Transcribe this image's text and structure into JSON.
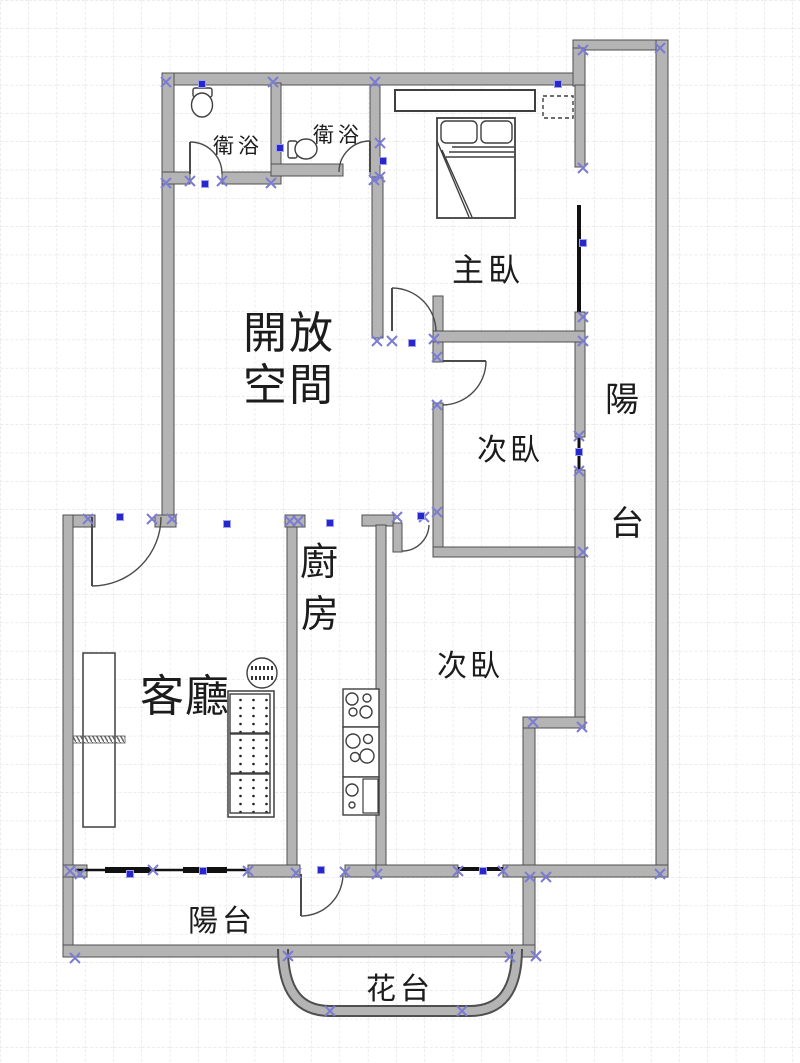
{
  "plan": {
    "width": 800,
    "height": 1063,
    "grid": {
      "spacing": 28.3,
      "color": "#d9d9d9",
      "dash": "3 2"
    },
    "colors": {
      "background": "#ffffff",
      "wall_fill": "#b4b4b4",
      "wall_stroke": "#4f4f4f",
      "line": "#3f3f3f",
      "window": "#111111",
      "marker_cross": "#7b7bd4",
      "marker_square": "#2727cc",
      "text": "#1c1c1c"
    },
    "labels": [
      {
        "name": "open-space-line1",
        "text": "開放",
        "x": 243,
        "y": 348,
        "size": 44,
        "ls": 2
      },
      {
        "name": "open-space-line2",
        "text": "空間",
        "x": 243,
        "y": 400,
        "size": 44,
        "ls": 2
      },
      {
        "name": "master-bedroom",
        "text": "主臥",
        "x": 452,
        "y": 281,
        "size": 32,
        "ls": 4
      },
      {
        "name": "bedroom-upper",
        "text": "次臥",
        "x": 477,
        "y": 460,
        "size": 30,
        "ls": 3
      },
      {
        "name": "bedroom-lower",
        "text": "次臥",
        "x": 437,
        "y": 676,
        "size": 30,
        "ls": 3
      },
      {
        "name": "balcony-right-char1",
        "text": "陽",
        "x": 605,
        "y": 411,
        "size": 34,
        "ls": 0
      },
      {
        "name": "balcony-right-char2",
        "text": "台",
        "x": 610,
        "y": 535,
        "size": 34,
        "ls": 0
      },
      {
        "name": "kitchen-char1",
        "text": "廚",
        "x": 300,
        "y": 575,
        "size": 38,
        "ls": 0
      },
      {
        "name": "kitchen-char2",
        "text": "房",
        "x": 301,
        "y": 627,
        "size": 38,
        "ls": 0
      },
      {
        "name": "living-room",
        "text": "客廳",
        "x": 140,
        "y": 711,
        "size": 44,
        "ls": 1
      },
      {
        "name": "bathroom-1",
        "text": "衛浴",
        "x": 213,
        "y": 153,
        "size": 21,
        "ls": 4
      },
      {
        "name": "bathroom-2",
        "text": "衛浴",
        "x": 313,
        "y": 142,
        "size": 21,
        "ls": 4
      },
      {
        "name": "balcony-bottom",
        "text": "陽台",
        "x": 188,
        "y": 931,
        "size": 30,
        "ls": 4
      },
      {
        "name": "flower-bed",
        "text": "花台",
        "x": 366,
        "y": 999,
        "size": 30,
        "ls": 4
      }
    ],
    "walls": [
      {
        "n": "wall-top-outer",
        "x": 162,
        "y": 73,
        "w": 423,
        "h": 12
      },
      {
        "n": "wall-balcony-top",
        "x": 573,
        "y": 40,
        "w": 95,
        "h": 10
      },
      {
        "n": "wall-balcony-connector",
        "x": 573,
        "y": 48,
        "w": 12,
        "h": 38
      },
      {
        "n": "wall-balcony-inner-upper",
        "x": 575,
        "y": 85,
        "w": 10,
        "h": 82
      },
      {
        "n": "wall-right-outer",
        "x": 656,
        "y": 40,
        "w": 12,
        "h": 837
      },
      {
        "n": "wall-left-outer-upper",
        "x": 162,
        "y": 73,
        "w": 12,
        "h": 447
      },
      {
        "n": "wall-bath-divider",
        "x": 271,
        "y": 83,
        "w": 10,
        "h": 101
      },
      {
        "n": "wall-bath1-bottom-left",
        "x": 162,
        "y": 172,
        "w": 28,
        "h": 12
      },
      {
        "n": "wall-bath1-bottom-right",
        "x": 222,
        "y": 172,
        "w": 59,
        "h": 12
      },
      {
        "n": "wall-bath2-bottom",
        "x": 271,
        "y": 164,
        "w": 72,
        "h": 12
      },
      {
        "n": "wall-bath2-right",
        "x": 370,
        "y": 85,
        "w": 10,
        "h": 92
      },
      {
        "n": "wall-master-separator",
        "x": 372,
        "y": 177,
        "w": 11,
        "h": 161
      },
      {
        "n": "wall-master-door-jamb",
        "x": 433,
        "y": 296,
        "w": 10,
        "h": 66
      },
      {
        "n": "wall-master-bottom",
        "x": 433,
        "y": 331,
        "w": 152,
        "h": 11
      },
      {
        "n": "wall-master-window-stub",
        "x": 575,
        "y": 312,
        "w": 10,
        "h": 19
      },
      {
        "n": "wall-bedroom-upper-left",
        "x": 433,
        "y": 403,
        "w": 10,
        "h": 154
      },
      {
        "n": "wall-bedroom-upper-bottom",
        "x": 433,
        "y": 547,
        "w": 152,
        "h": 10
      },
      {
        "n": "wall-bedroom-upper-right-a",
        "x": 575,
        "y": 342,
        "w": 10,
        "h": 95
      },
      {
        "n": "wall-bedroom-upper-right-b",
        "x": 575,
        "y": 470,
        "w": 10,
        "h": 87
      },
      {
        "n": "wall-bedroom-lower-right",
        "x": 575,
        "y": 557,
        "w": 10,
        "h": 165
      },
      {
        "n": "wall-balcony-jog",
        "x": 523,
        "y": 717,
        "w": 62,
        "h": 11
      },
      {
        "n": "wall-right-lower",
        "x": 523,
        "y": 728,
        "w": 12,
        "h": 229
      },
      {
        "n": "wall-living-top-left",
        "x": 63,
        "y": 515,
        "w": 32,
        "h": 12
      },
      {
        "n": "wall-living-top-mid",
        "x": 155,
        "y": 515,
        "w": 21,
        "h": 12
      },
      {
        "n": "wall-kitchen-left-cap",
        "x": 285,
        "y": 515,
        "w": 20,
        "h": 12
      },
      {
        "n": "wall-kitchen-left",
        "x": 287,
        "y": 527,
        "w": 10,
        "h": 350
      },
      {
        "n": "wall-kitchen-right-top",
        "x": 362,
        "y": 515,
        "w": 32,
        "h": 11
      },
      {
        "n": "door-leaf-bedroom-lower",
        "x": 393,
        "y": 523,
        "w": 9,
        "h": 29
      },
      {
        "n": "wall-kitchen-right",
        "x": 376,
        "y": 525,
        "w": 10,
        "h": 352
      },
      {
        "n": "wall-left-outer-lower",
        "x": 63,
        "y": 515,
        "w": 10,
        "h": 442
      },
      {
        "n": "wall-living-bottom-left",
        "x": 63,
        "y": 865,
        "w": 24,
        "h": 12
      },
      {
        "n": "wall-living-bottom-mid",
        "x": 248,
        "y": 865,
        "w": 52,
        "h": 12
      },
      {
        "n": "wall-kitchen-bottom",
        "x": 345,
        "y": 865,
        "w": 41,
        "h": 12
      },
      {
        "n": "wall-bedroom-lower-bottom-a",
        "x": 376,
        "y": 865,
        "w": 82,
        "h": 12
      },
      {
        "n": "wall-bedroom-lower-bottom-b",
        "x": 503,
        "y": 865,
        "w": 165,
        "h": 12
      },
      {
        "n": "wall-bottom-outer",
        "x": 63,
        "y": 945,
        "w": 472,
        "h": 12
      }
    ],
    "wall_paths": [
      {
        "n": "flower-bed-wall",
        "d": "M283,949 Q283,1011 330,1011 L470,1011 Q517,1011 517,949"
      }
    ],
    "windows": [
      {
        "n": "window-master-balcony",
        "x1": 579,
        "y1": 205,
        "x2": 579,
        "y2": 312,
        "sw": 4
      },
      {
        "n": "window-bedroom-upper",
        "x1": 579,
        "y1": 437,
        "x2": 579,
        "y2": 470,
        "sw": 3
      },
      {
        "n": "window-living-bottom",
        "x1": 75,
        "y1": 870,
        "x2": 248,
        "y2": 870,
        "sw": 2.5
      },
      {
        "n": "window-living-bottom-pane1",
        "x1": 105,
        "y1": 870,
        "x2": 150,
        "y2": 870,
        "sw": 6
      },
      {
        "n": "window-living-bottom-pane2",
        "x1": 183,
        "y1": 870,
        "x2": 227,
        "y2": 870,
        "sw": 6
      },
      {
        "n": "window-bedroom-lower",
        "x1": 458,
        "y1": 869,
        "x2": 503,
        "y2": 869,
        "sw": 4
      }
    ],
    "doors": [
      {
        "n": "door-bathroom-1",
        "leaf": "M190,142 L190,174",
        "arc": "M190,142 A32,32 0 0 1 222,174"
      },
      {
        "n": "door-bathroom-2",
        "leaf": "M370,141 L370,172",
        "arc": "M370,141 A31,31 0 0 0 339,172"
      },
      {
        "n": "door-master-bedroom",
        "leaf": "M392,288 L392,331",
        "arc": "M392,288 A44,44 0 0 1 436,331"
      },
      {
        "n": "door-bedroom-upper",
        "leaf": "M443,361 L486,361",
        "arc": "M486,361 A44,44 0 0 1 443,405"
      },
      {
        "n": "door-bedroom-lower",
        "arc": "M402,551 A27,27 0 0 0 429,525"
      },
      {
        "n": "door-entry",
        "leaf": "M92,517 L92,586",
        "arc": "M92,586 A69,69 0 0 0 161,517"
      },
      {
        "n": "door-balcony-bottom",
        "leaf": "M301,874 L301,916",
        "arc": "M301,916 A42,42 0 0 0 343,874"
      }
    ],
    "furniture": [
      {
        "n": "toilet-tank",
        "t": "rect",
        "x": 193,
        "y": 88,
        "w": 19,
        "h": 9,
        "rx": 2
      },
      {
        "n": "toilet-bowl",
        "t": "ellipse",
        "cx": 202,
        "cy": 105,
        "rx": 10.5,
        "ry": 12
      },
      {
        "n": "toilet-tank",
        "t": "rect",
        "x": 288,
        "y": 141,
        "w": 9,
        "h": 17,
        "rx": 2
      },
      {
        "n": "toilet-bowl",
        "t": "ellipse",
        "cx": 306,
        "cy": 149,
        "rx": 11,
        "ry": 10
      },
      {
        "n": "wardrobe",
        "t": "rect",
        "x": 395,
        "y": 90,
        "w": 140,
        "h": 21,
        "sw": 2
      },
      {
        "n": "ac-unit",
        "t": "rect",
        "x": 543,
        "y": 96,
        "w": 30,
        "h": 22,
        "dash": "4 3",
        "f": "none"
      },
      {
        "n": "bed-frame",
        "t": "rect",
        "x": 437,
        "y": 118,
        "w": 78,
        "h": 100,
        "sw": 1.8
      },
      {
        "n": "bed-pillow",
        "t": "rect",
        "x": 441,
        "y": 121,
        "w": 36,
        "h": 22,
        "rx": 5
      },
      {
        "n": "bed-pillow",
        "t": "rect",
        "x": 481,
        "y": 121,
        "w": 31,
        "h": 22,
        "rx": 5
      },
      {
        "n": "bed-blanket-lines",
        "t": "path",
        "d": "M452,147 L514,147 M449,152 L514,152 M446,157 L514,157",
        "f": "none"
      },
      {
        "n": "bed-fold",
        "t": "path",
        "d": "M437,141 L469,217 M442,150 L472,217",
        "f": "none"
      },
      {
        "n": "tv-cabinet",
        "t": "rect",
        "x": 83,
        "y": 653,
        "w": 32,
        "h": 174,
        "sw": 1.5
      },
      {
        "n": "window-sill-hatch",
        "t": "rect",
        "x": 73,
        "y": 736,
        "w": 52,
        "h": 7,
        "f": "url(#hatch)",
        "s": "#555",
        "sw": 0.8
      },
      {
        "n": "fan-table",
        "t": "circle",
        "cx": 262,
        "cy": 673,
        "r": 15
      },
      {
        "n": "fan-table-lines",
        "t": "path",
        "d": "M251,668 L274,668 M251,678 L274,678",
        "f": "none",
        "s": "#333",
        "sw": 4,
        "dash": "2 2"
      },
      {
        "n": "sofa-frame",
        "t": "rect",
        "x": 228,
        "y": 691,
        "w": 46,
        "h": 126,
        "sw": 1.5
      },
      {
        "n": "sofa-cushion",
        "t": "rect",
        "x": 230,
        "y": 694,
        "w": 40,
        "h": 39,
        "f": "url(#dots)"
      },
      {
        "n": "sofa-cushion",
        "t": "rect",
        "x": 230,
        "y": 734,
        "w": 40,
        "h": 39,
        "f": "url(#dots)"
      },
      {
        "n": "sofa-cushion",
        "t": "rect",
        "x": 230,
        "y": 774,
        "w": 40,
        "h": 39,
        "f": "url(#dots)"
      },
      {
        "n": "stove",
        "t": "rect",
        "x": 343,
        "y": 689,
        "w": 36,
        "h": 38
      },
      {
        "n": "stove-burner",
        "t": "circle",
        "cx": 352,
        "cy": 699,
        "r": 6
      },
      {
        "n": "stove-burner",
        "t": "circle",
        "cx": 367,
        "cy": 698,
        "r": 4
      },
      {
        "n": "stove-burner",
        "t": "circle",
        "cx": 353,
        "cy": 712,
        "r": 4
      },
      {
        "n": "stove-burner",
        "t": "circle",
        "cx": 366,
        "cy": 712,
        "r": 6
      },
      {
        "n": "counter",
        "t": "rect",
        "x": 343,
        "y": 727,
        "w": 36,
        "h": 50
      },
      {
        "n": "counter-burner",
        "t": "circle",
        "cx": 353,
        "cy": 741,
        "r": 7
      },
      {
        "n": "counter-burner",
        "t": "circle",
        "cx": 368,
        "cy": 739,
        "r": 4.5
      },
      {
        "n": "counter-burner",
        "t": "circle",
        "cx": 355,
        "cy": 757,
        "r": 4.5
      },
      {
        "n": "counter-burner",
        "t": "circle",
        "cx": 367,
        "cy": 756,
        "r": 7
      },
      {
        "n": "sink-unit",
        "t": "rect",
        "x": 343,
        "y": 777,
        "w": 36,
        "h": 38
      },
      {
        "n": "sink-board",
        "t": "rect",
        "x": 363,
        "y": 779,
        "w": 15,
        "h": 34,
        "sw": 1.2
      },
      {
        "n": "sink-basin",
        "t": "circle",
        "cx": 352,
        "cy": 790,
        "r": 6
      },
      {
        "n": "sink-drain",
        "t": "circle",
        "cx": 352,
        "cy": 805,
        "r": 3
      }
    ],
    "markers": {
      "cross": [
        [
          166,
          82
        ],
        [
          273,
          82
        ],
        [
          375,
          82
        ],
        [
          583,
          50
        ],
        [
          660,
          48
        ],
        [
          166,
          183
        ],
        [
          190,
          181
        ],
        [
          222,
          181
        ],
        [
          271,
          183
        ],
        [
          374,
          180
        ],
        [
          380,
          143
        ],
        [
          380,
          177
        ],
        [
          583,
          168
        ],
        [
          583,
          317
        ],
        [
          583,
          341
        ],
        [
          579,
          436
        ],
        [
          579,
          471
        ],
        [
          583,
          552
        ],
        [
          377,
          341
        ],
        [
          392,
          341
        ],
        [
          434,
          339
        ],
        [
          437,
          357
        ],
        [
          437,
          405
        ],
        [
          88,
          519
        ],
        [
          152,
          519
        ],
        [
          172,
          519
        ],
        [
          290,
          521
        ],
        [
          298,
          521
        ],
        [
          397,
          517
        ],
        [
          424,
          517
        ],
        [
          437,
          512
        ],
        [
          533,
          722
        ],
        [
          582,
          727
        ],
        [
          70,
          871
        ],
        [
          80,
          874
        ],
        [
          153,
          870
        ],
        [
          248,
          871
        ],
        [
          296,
          873
        ],
        [
          345,
          872
        ],
        [
          377,
          874
        ],
        [
          458,
          871
        ],
        [
          503,
          871
        ],
        [
          530,
          877
        ],
        [
          546,
          877
        ],
        [
          660,
          874
        ],
        [
          75,
          958
        ],
        [
          288,
          956
        ],
        [
          510,
          957
        ],
        [
          536,
          956
        ],
        [
          330,
          1011
        ],
        [
          462,
          1011
        ]
      ],
      "square": [
        [
          202,
          84
        ],
        [
          558,
          84
        ],
        [
          280,
          148
        ],
        [
          205,
          184
        ],
        [
          383,
          161
        ],
        [
          583,
          243
        ],
        [
          412,
          343
        ],
        [
          120,
          517
        ],
        [
          227,
          524
        ],
        [
          330,
          523
        ],
        [
          421,
          516
        ],
        [
          579,
          452
        ],
        [
          130,
          874
        ],
        [
          203,
          871
        ],
        [
          321,
          870
        ],
        [
          483,
          871
        ]
      ]
    }
  }
}
